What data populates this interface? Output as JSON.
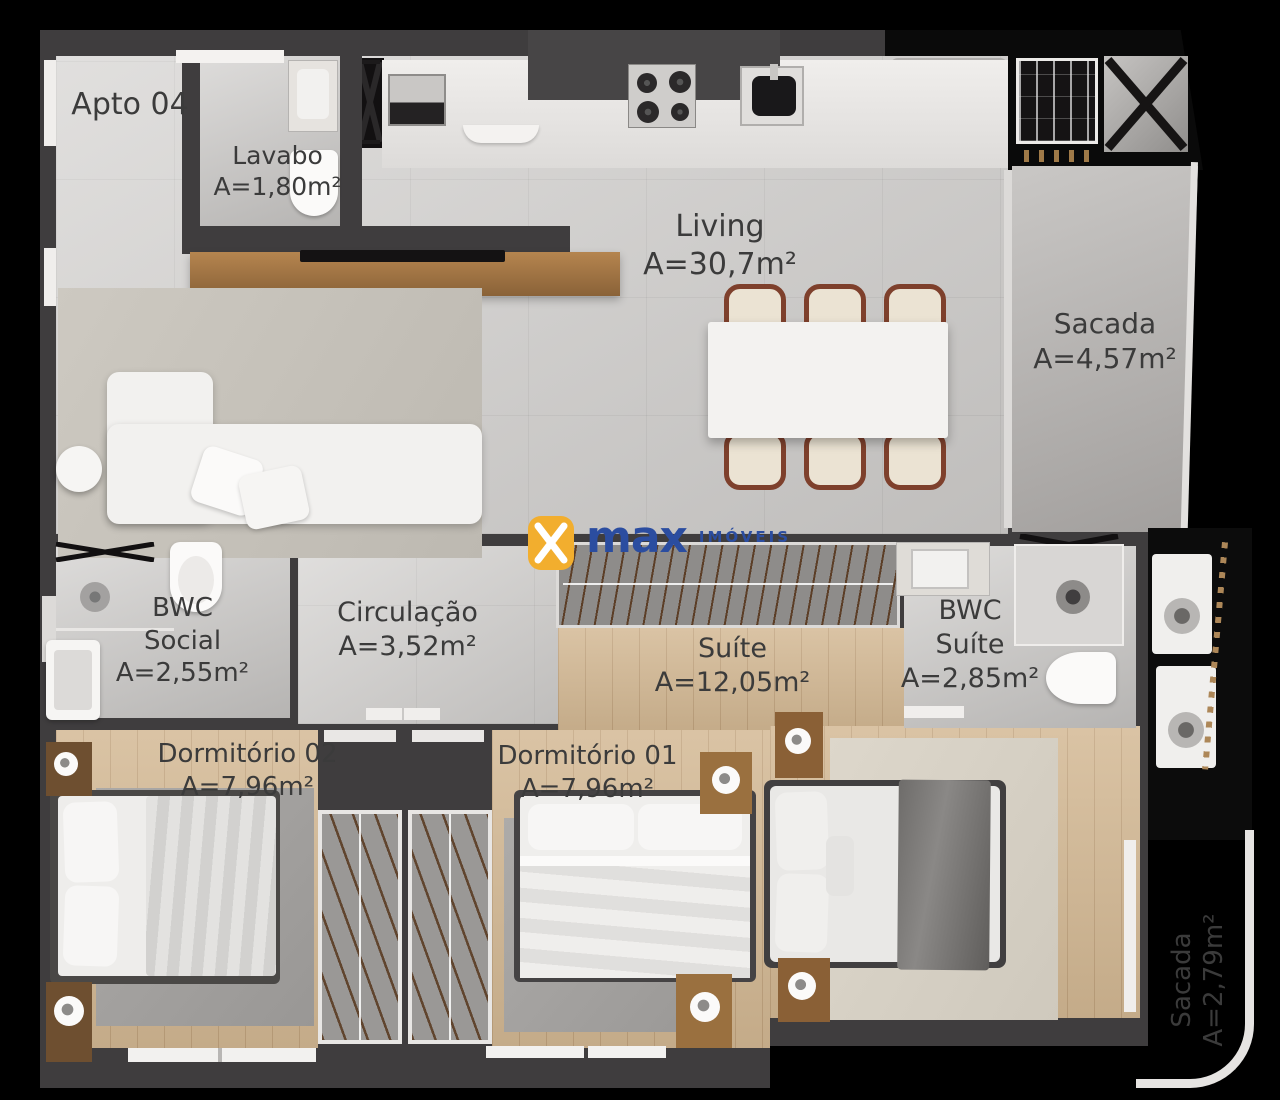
{
  "meta": {
    "unit_label": "Apto 04",
    "brand": "max",
    "brand_suffix": "IMÓVEIS"
  },
  "rooms": {
    "lavabo": {
      "name": "Lavabo",
      "area": "A=1,80m²"
    },
    "living": {
      "name": "Living",
      "area": "A=30,7m²"
    },
    "sacada_living": {
      "name": "Sacada",
      "area": "A=4,57m²"
    },
    "bwc_social": {
      "name1": "BWC",
      "name2": "Social",
      "area": "A=2,55m²"
    },
    "circulacao": {
      "name": "Circulação",
      "area": "A=3,52m²"
    },
    "suite": {
      "name": "Suíte",
      "area": "A=12,05m²"
    },
    "bwc_suite": {
      "name1": "BWC",
      "name2": "Suíte",
      "area": "A=2,85m²"
    },
    "dormitorio_02": {
      "name": "Dormitório 02",
      "area": "A=7,96m²"
    },
    "dormitorio_01": {
      "name": "Dormitório 01",
      "area": "A=7,96m²"
    },
    "sacada_suite": {
      "name": "Sacada",
      "area": "A=2,79m²"
    }
  },
  "colors": {
    "background": "#000000",
    "wall": "#3F3D3E",
    "tile_floor": "#D5D3D1",
    "wood_floor": "#D3B893",
    "label_text": "#3B3B3B",
    "logo_yellow": "#F2AE2E",
    "logo_blue": "#2B4DA0",
    "chair_wood": "#7E402C"
  }
}
